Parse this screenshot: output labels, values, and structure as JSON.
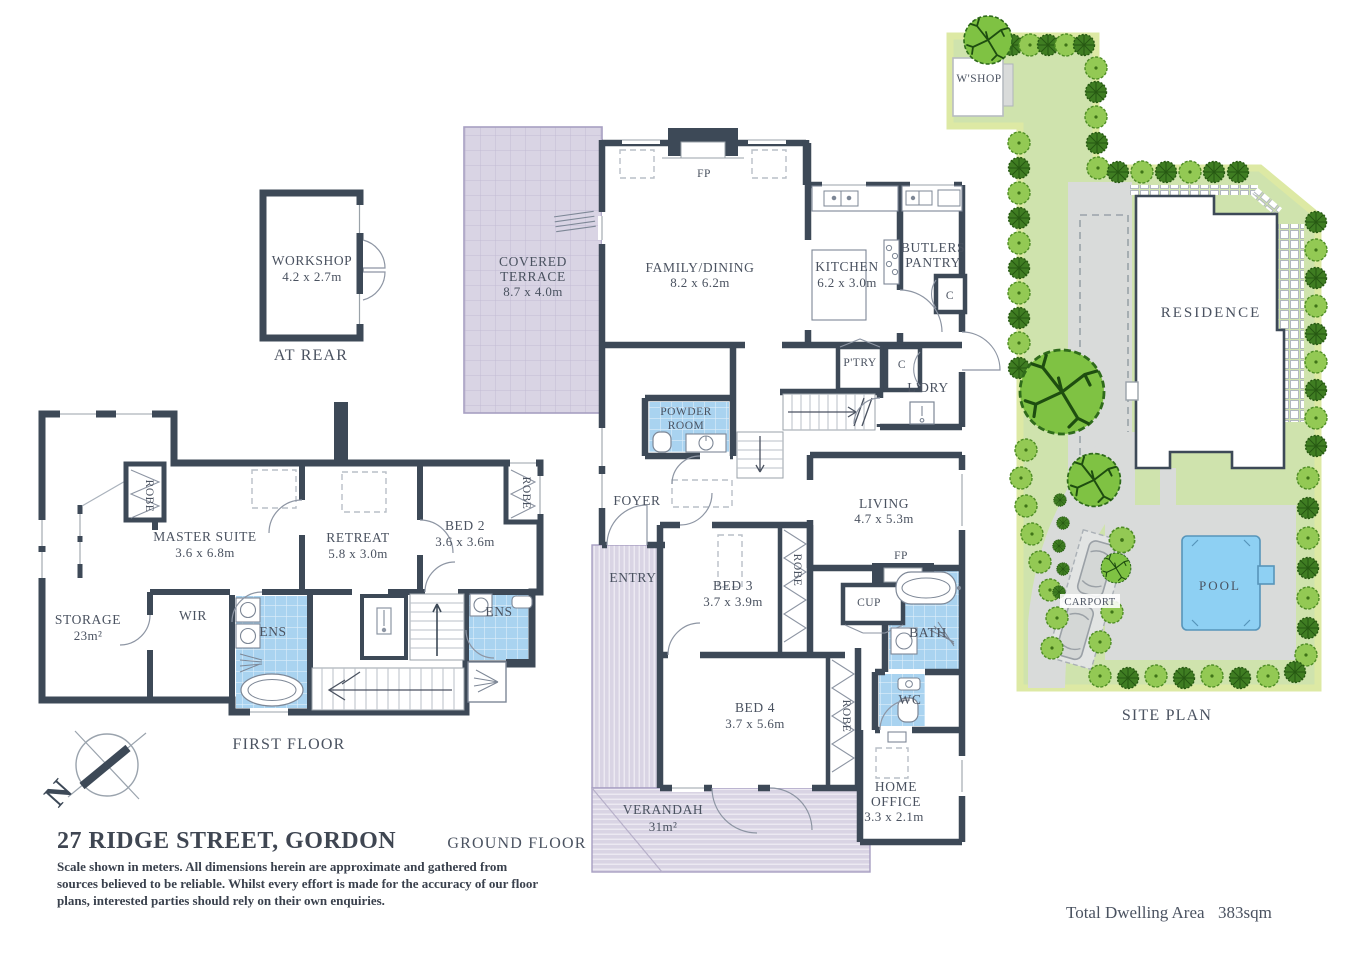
{
  "title": "27 RIDGE STREET, GORDON",
  "disclaimer": {
    "line1": "Scale shown in meters. All dimensions herein are approximate and gathered from",
    "line2": "sources believed to be reliable. Whilst every effort is made for the accuracy of our floor",
    "line3": "plans, interested parties should rely on their own enquiries."
  },
  "total_area": {
    "label": "Total Dwelling Area",
    "value": "383sqm"
  },
  "sections": {
    "first_floor": "FIRST FLOOR",
    "ground_floor": "GROUND FLOOR",
    "site_plan": "SITE PLAN",
    "at_rear": "AT REAR"
  },
  "compass": {
    "north": "N"
  },
  "rooms": {
    "workshop": {
      "name": "WORKSHOP",
      "dims": "4.2 x 2.7m"
    },
    "covered_terrace": {
      "name1": "COVERED",
      "name2": "TERRACE",
      "dims": "8.7 x 4.0m"
    },
    "family_dining": {
      "name": "FAMILY/DINING",
      "dims": "8.2 x 6.2m"
    },
    "kitchen": {
      "name": "KITCHEN",
      "dims": "6.2 x 3.0m"
    },
    "butlers_pantry": {
      "name1": "BUTLERS",
      "name2": "PANTRY"
    },
    "pantry": "P'TRY",
    "laundry": "L'DRY",
    "cupboard": "C",
    "powder_room": {
      "name1": "POWDER",
      "name2": "ROOM"
    },
    "foyer": "FOYER",
    "entry": "ENTRY",
    "living": {
      "name": "LIVING",
      "dims": "4.7 x 5.3m"
    },
    "fireplace": "FP",
    "cup": "CUP",
    "bath": "BATH",
    "wc": "WC",
    "robe": "ROBE",
    "bed3": {
      "name": "BED 3",
      "dims": "3.7 x 3.9m"
    },
    "bed4": {
      "name": "BED 4",
      "dims": "3.7 x 5.6m"
    },
    "home_office": {
      "name1": "HOME",
      "name2": "OFFICE",
      "dims": "3.3 x 2.1m"
    },
    "verandah": {
      "name": "VERANDAH",
      "dims": "31m²"
    },
    "master_suite": {
      "name": "MASTER SUITE",
      "dims": "3.6 x 6.8m"
    },
    "retreat": {
      "name": "RETREAT",
      "dims": "5.8 x 3.0m"
    },
    "bed2": {
      "name": "BED 2",
      "dims": "3.6 x 3.6m"
    },
    "storage": {
      "name": "STORAGE",
      "dims": "23m²"
    },
    "wir": "WIR",
    "ens": "ENS"
  },
  "site": {
    "wshop": "W'SHOP",
    "residence": "RESIDENCE",
    "pool": "POOL",
    "carport": "CARPORT"
  },
  "colors": {
    "wall": "#3d4957",
    "tile_blue": "#a9d3f0",
    "terrace_lavender": "#d9d4e4",
    "lawn_green": "#cfe3ad",
    "boundary_strip": "#dde9a4",
    "pool_blue": "#8ed0f3",
    "driveway_gray": "#d9dbda",
    "tree_light": "#93c954",
    "tree_dark": "#3f7d22",
    "text": "#4a5260"
  }
}
